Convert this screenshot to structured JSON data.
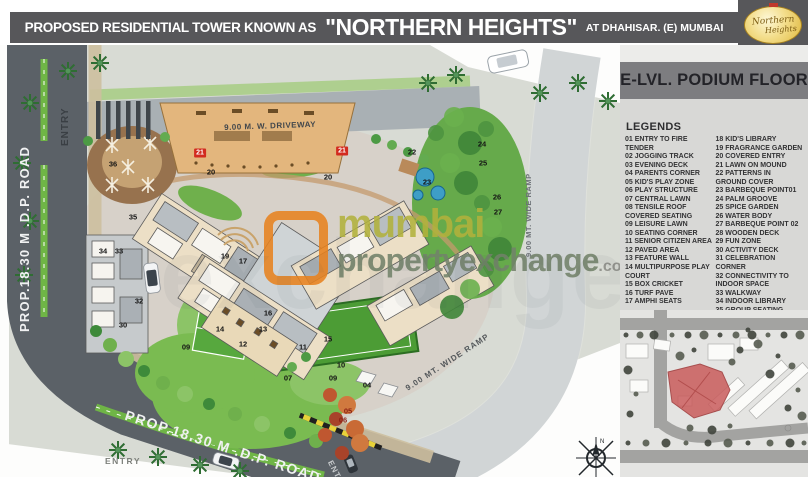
{
  "header": {
    "title_prefix": "PROPOSED RESIDENTIAL TOWER KNOWN AS",
    "title_name": "\"NORTHERN HEIGHTS\"",
    "title_suffix": "AT DHAHISAR. (E) MUMBAI",
    "logo_line1": "Northern",
    "logo_line2": "Heights"
  },
  "panel": {
    "floor_title": "E-LVL. PODIUM FLOOR",
    "legends_heading": "LEGENDS",
    "legend_col1": [
      "01 ENTRY TO FIRE TENDER",
      "02 JOGGING TRACK",
      "03 EVENING DECK",
      "04 PARENTS CORNER",
      "05 KID'S PLAY ZONE",
      "06 PLAY STRUCTURE",
      "07 CENTRAL LAWN",
      "08 TENSILE ROOF COVERED SEATING",
      "09 LEISURE LAWN",
      "10 SEATING CORNER",
      "11 SENIOR CITIZEN AREA",
      "12 PAVED AREA",
      "13 FEATURE WALL",
      "14 MULTIPURPOSE PLAY COURT",
      "15 BOX CRICKET",
      "16 TURF PAVE",
      "17 AMPHI SEATS"
    ],
    "legend_col2": [
      "18 KID'S LIBRARY",
      "19 FRAGRANCE GARDEN",
      "20 COVERED ENTRY",
      "21 LAWN ON MOUND",
      "22 PATTERNS IN GROUND COVER",
      "23 BARBEQUE POINT01",
      "24 PALM GROOVE",
      "25 SPICE GARDEN",
      "26 WATER BODY",
      "27 BARBEQUE POINT 02",
      "28 WOODEN DECK",
      "29 FUN ZONE",
      "30 ACTIVITY DECK",
      "31 CELEBRATION CORNER",
      "32 CONNECTIVITY TO INDOOR SPACE",
      "33 WALKWAY",
      "34 INDOOR LIBRARY",
      "35 GROUP SEATING",
      "36LEISURE DECK"
    ]
  },
  "plan": {
    "labels": {
      "driveway": "9.00 M. W. DRIVEWAY",
      "road_left": "PROP.18.30 M .D.P. ROAD",
      "road_bottom": "PROP.18.30 M .D.P. ROAD",
      "ramp_diag": "9.00 MT. WIDE RAMP",
      "ramp_vert": "9.00 MT. WIDE RAMP",
      "entry_top": "ENTRY",
      "entry_bottom_left": "ENTRY",
      "entry_gate": "ENTRY"
    },
    "compass_label": "N",
    "markers": [
      {
        "n": "36",
        "x": 113,
        "y": 119
      },
      {
        "n": "21",
        "x": 200,
        "y": 108,
        "s": "red"
      },
      {
        "n": "20",
        "x": 211,
        "y": 127
      },
      {
        "n": "21",
        "x": 342,
        "y": 106,
        "s": "red"
      },
      {
        "n": "20",
        "x": 328,
        "y": 132
      },
      {
        "n": "35",
        "x": 133,
        "y": 172
      },
      {
        "n": "34",
        "x": 103,
        "y": 206
      },
      {
        "n": "33",
        "x": 119,
        "y": 206
      },
      {
        "n": "19",
        "x": 225,
        "y": 211
      },
      {
        "n": "17",
        "x": 243,
        "y": 216
      },
      {
        "n": "32",
        "x": 139,
        "y": 256
      },
      {
        "n": "30",
        "x": 123,
        "y": 280
      },
      {
        "n": "16",
        "x": 268,
        "y": 268
      },
      {
        "n": "14",
        "x": 220,
        "y": 284
      },
      {
        "n": "13",
        "x": 263,
        "y": 284
      },
      {
        "n": "12",
        "x": 243,
        "y": 299
      },
      {
        "n": "11",
        "x": 303,
        "y": 302
      },
      {
        "n": "15",
        "x": 328,
        "y": 294
      },
      {
        "n": "09",
        "x": 186,
        "y": 302
      },
      {
        "n": "09",
        "x": 333,
        "y": 333
      },
      {
        "n": "07",
        "x": 288,
        "y": 333
      },
      {
        "n": "10",
        "x": 341,
        "y": 320
      },
      {
        "n": "04",
        "x": 367,
        "y": 340
      },
      {
        "n": "05",
        "x": 348,
        "y": 366,
        "s": "maroon"
      },
      {
        "n": "06",
        "x": 343,
        "y": 375,
        "s": "maroon"
      },
      {
        "n": "22",
        "x": 412,
        "y": 107
      },
      {
        "n": "24",
        "x": 482,
        "y": 99
      },
      {
        "n": "25",
        "x": 483,
        "y": 118
      },
      {
        "n": "23",
        "x": 427,
        "y": 137
      },
      {
        "n": "26",
        "x": 497,
        "y": 152
      },
      {
        "n": "27",
        "x": 498,
        "y": 167
      }
    ]
  },
  "watermark": {
    "word1": "mumbai",
    "word2": "propertyexchange",
    "word3": ".com",
    "big_text": "exchange.com",
    "accent_color": "#e8821e",
    "word1_color": "#b2b23c",
    "word2_color": "#72826a"
  },
  "colors": {
    "header_bar": "#57575a",
    "road": "#5b6167",
    "median_green": "#6fb546",
    "keyplan_site_red": "#c95c5c"
  }
}
